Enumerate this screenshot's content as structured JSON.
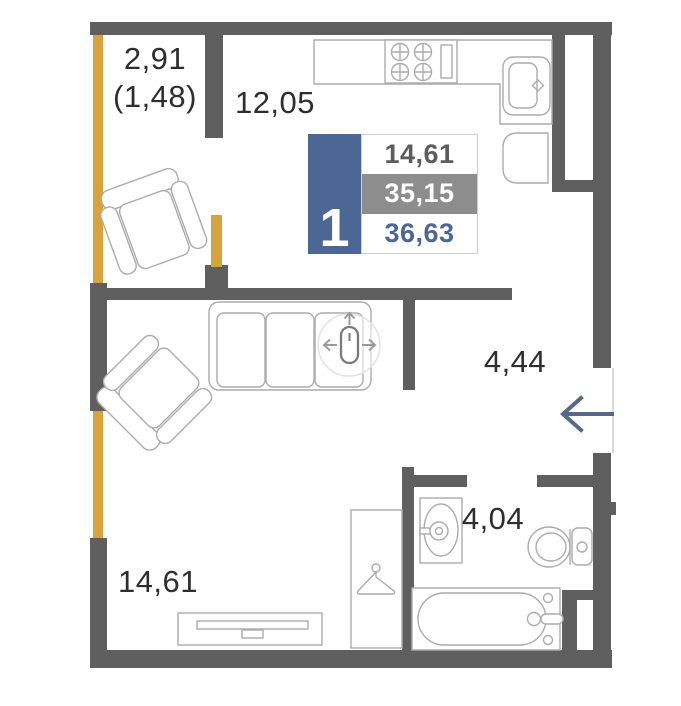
{
  "colors": {
    "wall": "#5F5F5F",
    "window": "#D6A33F",
    "accent_blue": "#4D6795",
    "row_gray": "#8D8D8D",
    "label_text": "#2E2E2E",
    "arrow": "#57698A",
    "furniture_line": "#ACACAC"
  },
  "rooms": {
    "balcony": {
      "label": "2,91",
      "label_secondary": "(1,48)"
    },
    "kitchen_living": {
      "label": "12,05"
    },
    "hallway": {
      "label": "4,44"
    },
    "bathroom": {
      "label": "4,04"
    },
    "living_room": {
      "label": "14,61"
    }
  },
  "info_card": {
    "rooms_count": "1",
    "living_area": "14,61",
    "area_without_balcony": "35,15",
    "total_area": "36,63"
  },
  "furniture": {
    "balcony": [
      "armchair"
    ],
    "kitchen": [
      "counter",
      "stove",
      "sink",
      "fridge"
    ],
    "living_room": [
      "sofa",
      "armchair",
      "tv-stand",
      "wardrobe"
    ],
    "bathroom": [
      "sink",
      "toilet",
      "bathtub"
    ]
  },
  "icons": {
    "entrance_arrow": "left-arrow",
    "hanger": "clothes-hanger",
    "move_handle": "move-crosshair"
  }
}
